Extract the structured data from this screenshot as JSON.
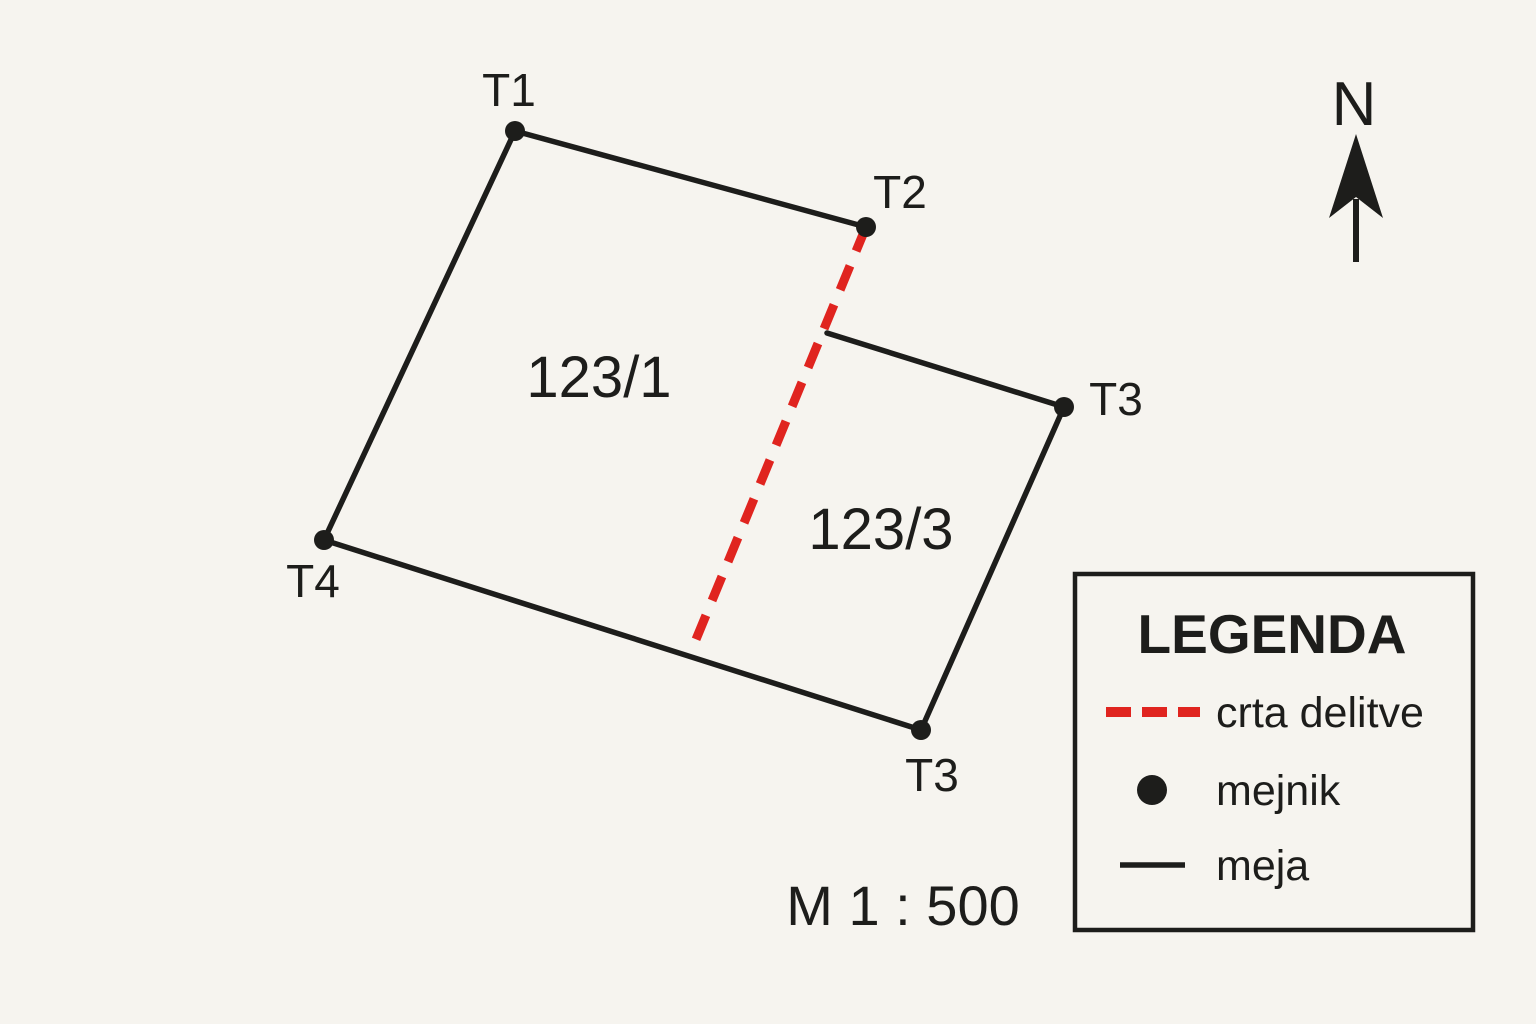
{
  "colors": {
    "background": "#f6f4ef",
    "ink": "#1d1d1b",
    "division_line": "#e0241f"
  },
  "points": [
    {
      "label": "T1"
    },
    {
      "label": "T2"
    },
    {
      "label": "T3"
    },
    {
      "label": "T3"
    },
    {
      "label": "T4"
    }
  ],
  "parcels": [
    {
      "label": "123/1"
    },
    {
      "label": "123/3"
    }
  ],
  "north": {
    "label": "N"
  },
  "scale": {
    "label": "M 1 : 500"
  },
  "legend": {
    "title": "LEGENDA",
    "items": [
      {
        "symbol": "dashed-red-line",
        "label": "crta delitve"
      },
      {
        "symbol": "black-dot",
        "label": "mejnik"
      },
      {
        "symbol": "black-line",
        "label": "meja"
      }
    ]
  }
}
